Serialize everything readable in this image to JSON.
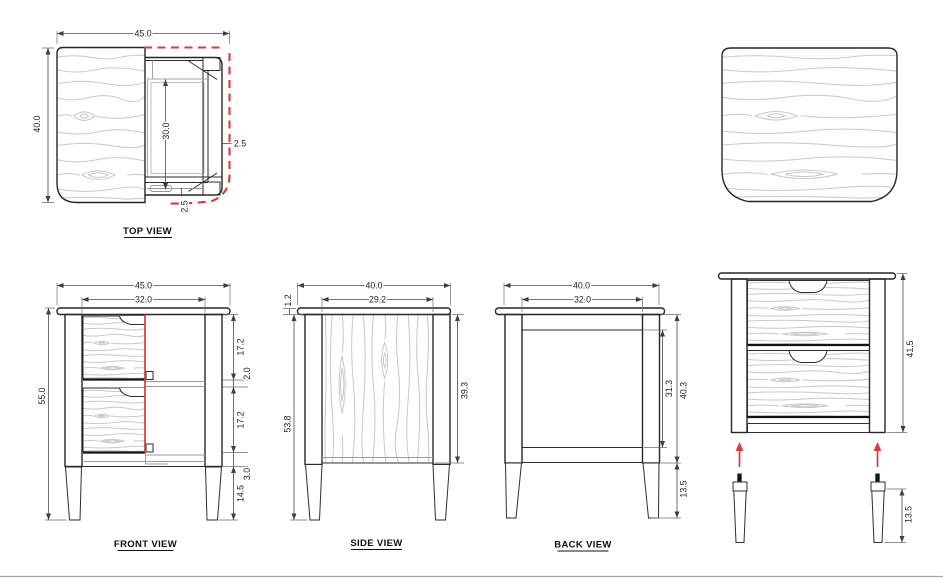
{
  "drawing": {
    "sheet_background": "#ffffff",
    "colors": {
      "outline": "#262626",
      "construction_gray": "#9a9a9a",
      "wood_grain": "#c9c9c9",
      "dimension_text": "#1d1d1d",
      "section_red": "#dc3a33",
      "sheet_line": "#a8a8a8"
    },
    "views": {
      "top": {
        "label": "TOP VIEW",
        "dims": {
          "overall_width": "45.0",
          "overall_depth": "40.0",
          "drawer_opening_depth": "30.0",
          "side_clearance": "2.5",
          "front_rail_thickness": "2.5"
        }
      },
      "front": {
        "label": "FRONT VIEW",
        "dims": {
          "overall_width": "45.0",
          "drawer_width": "32.0",
          "overall_height": "55.0",
          "top_drawer_height": "17.2",
          "divider_thickness": "2.0",
          "bottom_drawer_height": "17.2",
          "base_rail_height": "3.0",
          "leg_height": "14.5"
        }
      },
      "side": {
        "label": "SIDE VIEW",
        "dims": {
          "overall_depth": "40.0",
          "panel_width": "29.2",
          "top_thickness": "1.2",
          "body_height": "53.8",
          "panel_height": "39.3"
        }
      },
      "back": {
        "label": "BACK VIEW",
        "dims": {
          "frame_width": "40.0",
          "inner_width": "32.0",
          "panel_height": "31.3",
          "frame_height": "40.3",
          "leg_height": "13.5"
        }
      },
      "exploded": {
        "dims": {
          "carcass_height": "41.5",
          "leg_height": "13.5"
        }
      }
    }
  }
}
